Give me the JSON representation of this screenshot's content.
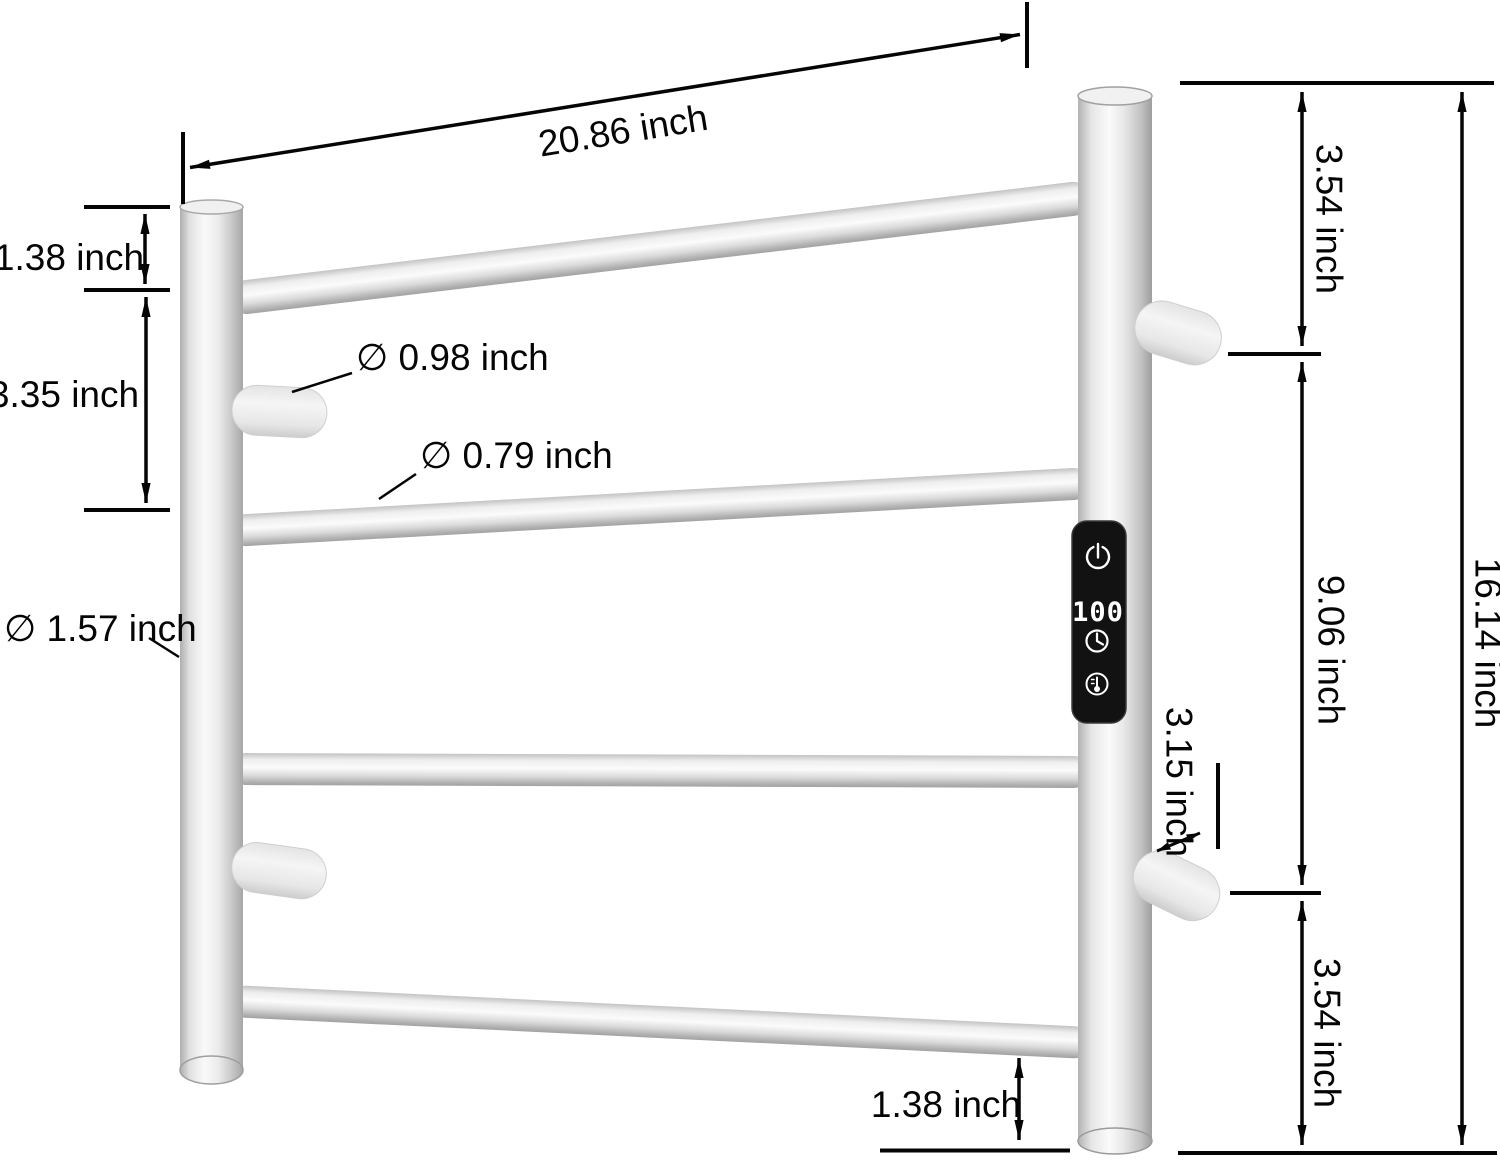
{
  "figure": {
    "kind": "product-dimension-diagram",
    "subject": "wall-mounted heated towel rack with 4 cross bars, 4 side hooks and a digital control panel"
  },
  "dims": {
    "width_top": "20.86 inch",
    "gap_top_left": "1.38 inch",
    "spacing_left": "3.35 inch",
    "dia_hook": "∅ 0.98 inch",
    "dia_bar": "∅ 0.79 inch",
    "dia_post": "∅ 1.57 inch",
    "gap_top_right": "3.54 inch",
    "span_mid_right": "9.06 inch",
    "gap_bottom_right": "3.54 inch",
    "height_total": "16.14 inch",
    "hook_depth_right": "3.15 inch",
    "gap_bottom": "1.38 inch"
  },
  "panel": {
    "display": "100",
    "icons": [
      "power",
      "timer",
      "temperature"
    ]
  },
  "colors": {
    "background": "#ffffff",
    "annotation": "#050505",
    "steel_highlight": "#fbfbfb",
    "steel_mid": "#d9d9d9",
    "steel_shadow": "#a5a5a5",
    "hook_white": "#f0f0f0",
    "panel_black": "#121212",
    "led_white": "#ffffff"
  }
}
